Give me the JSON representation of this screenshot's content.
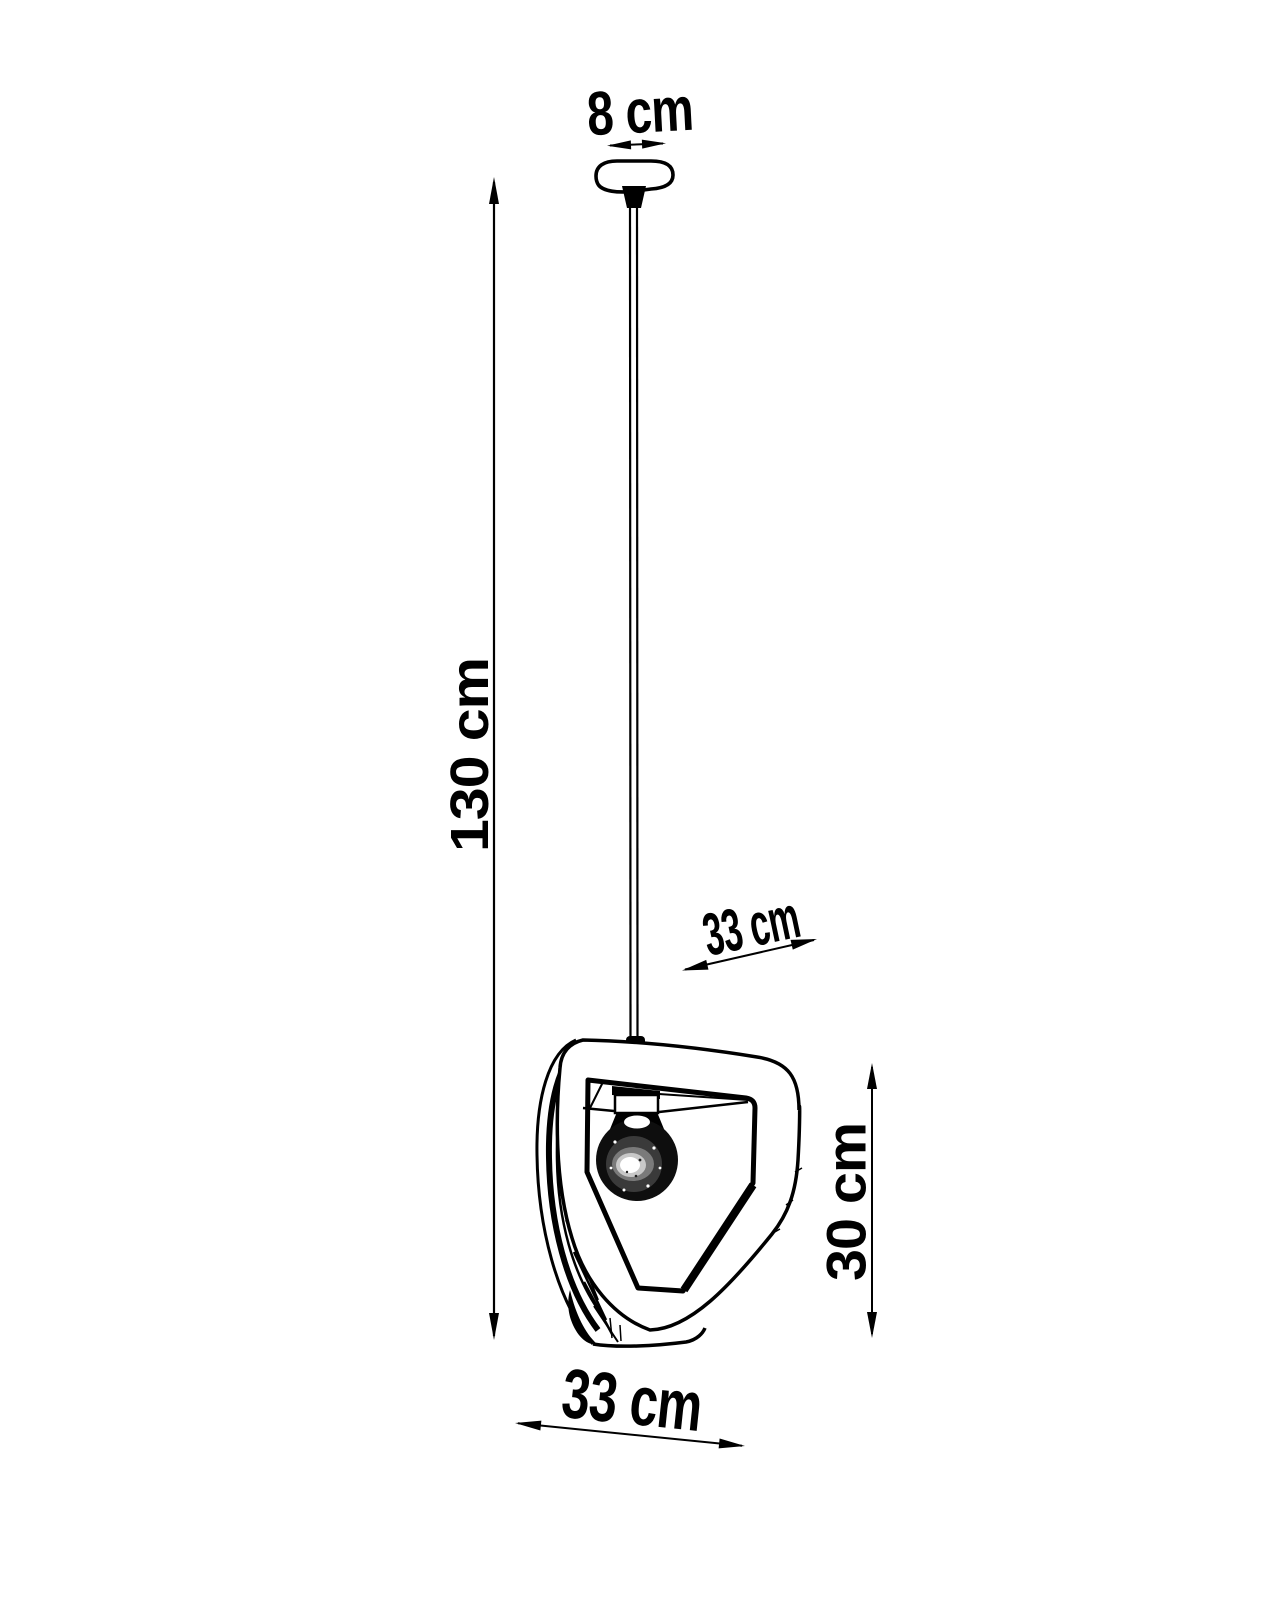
{
  "title": "Pendant lamp technical dimension drawing",
  "colors": {
    "background": "#ffffff",
    "ink": "#000000"
  },
  "subject": "pendant-lamp",
  "dims": {
    "canopy_width": {
      "label": "8 cm",
      "orientation": "horizontal-top"
    },
    "drop_height": {
      "label": "130 cm",
      "orientation": "vertical-left"
    },
    "shade_depth": {
      "label": "33 cm",
      "orientation": "diagonal-middle"
    },
    "shade_height": {
      "label": "30 cm",
      "orientation": "vertical-right"
    },
    "shade_width": {
      "label": "33 cm",
      "orientation": "horizontal-bottom"
    }
  }
}
